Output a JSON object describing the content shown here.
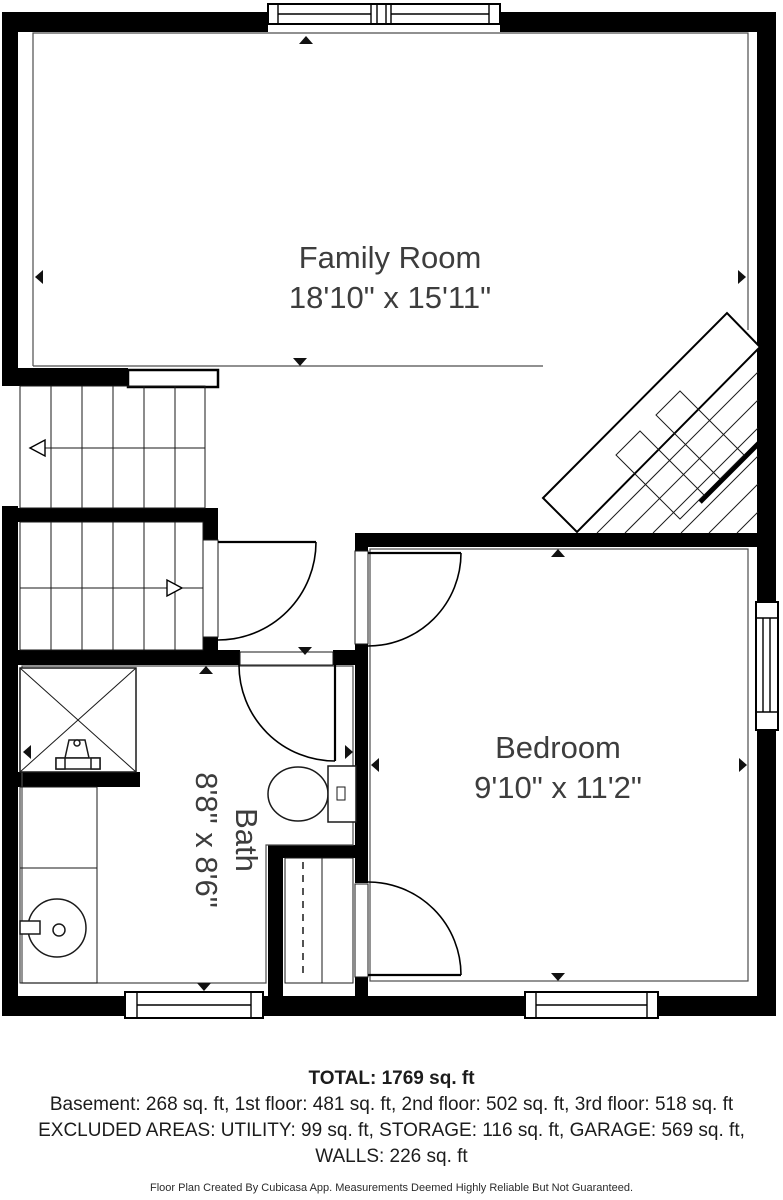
{
  "plan": {
    "rooms": [
      {
        "name": "Family Room",
        "dims": "18'10\" x 15'11\""
      },
      {
        "name": "Bedroom",
        "dims": "9'10\" x 11'2\""
      },
      {
        "name": "Bath",
        "dims": "8'8\" x 8'6\""
      }
    ]
  },
  "summary": {
    "total": "TOTAL: 1769 sq. ft",
    "floors": "Basement: 268 sq. ft, 1st floor: 481 sq. ft, 2nd floor: 502 sq. ft, 3rd floor: 518 sq. ft",
    "excluded": "EXCLUDED AREAS: UTILITY: 99 sq. ft, STORAGE: 116 sq. ft, GARAGE: 569 sq. ft,",
    "walls": "WALLS: 226 sq. ft"
  },
  "footer": "Floor Plan Created By Cubicasa App. Measurements Deemed Highly Reliable But Not Guaranteed.",
  "colors": {
    "wall": "#000000",
    "background": "#ffffff",
    "label_text": "#3d3d3d",
    "summary_text": "#1c1c1c",
    "room_outline": "#4d4d4d"
  }
}
